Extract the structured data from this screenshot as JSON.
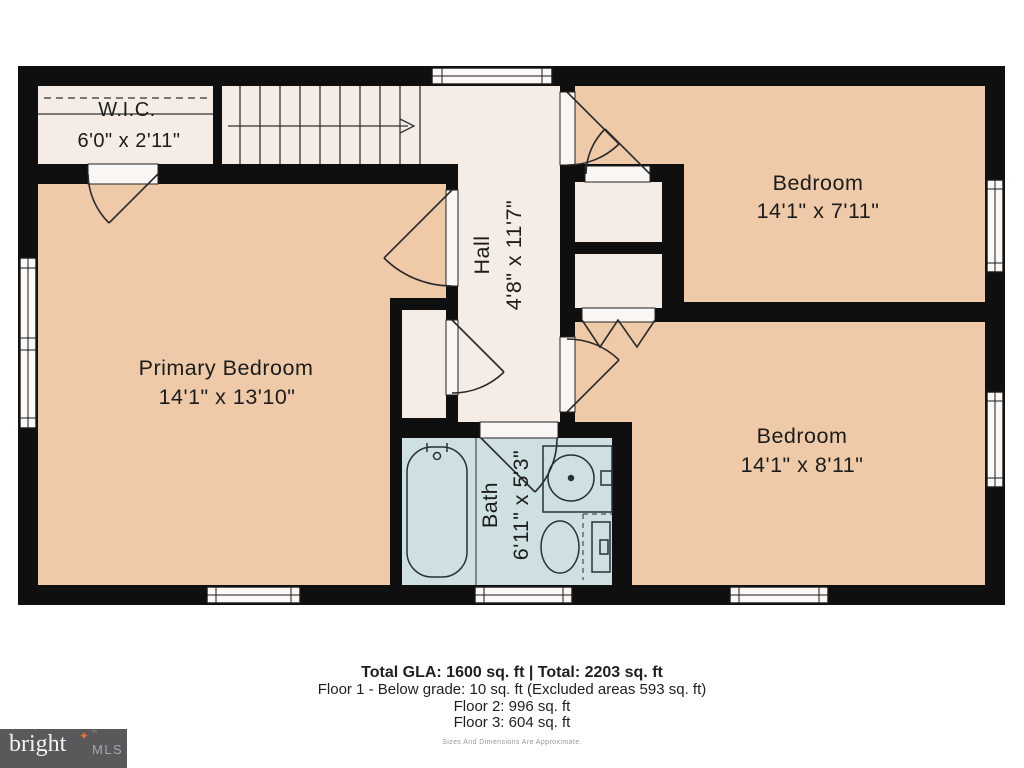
{
  "rooms": {
    "wic": {
      "label": "W.I.C.",
      "dims": "6'0\" x 2'11\""
    },
    "primary": {
      "label": "Primary Bedroom",
      "dims": "14'1\" x 13'10\""
    },
    "bedroom_top": {
      "label": "Bedroom",
      "dims": "14'1\" x 7'11\""
    },
    "bedroom_bottom": {
      "label": "Bedroom",
      "dims": "14'1\" x 8'11\""
    },
    "hall": {
      "label": "Hall",
      "dims": "4'8\" x 11'7\""
    },
    "bath": {
      "label": "Bath",
      "dims": "6'11\" x 5'3\""
    }
  },
  "summary": {
    "line1": "Total GLA: 1600 sq. ft | Total: 2203 sq. ft",
    "line2": "Floor 1 - Below grade: 10 sq. ft (Excluded areas 593 sq. ft)",
    "line3": "Floor 2: 996 sq. ft",
    "line4": "Floor 3: 604 sq. ft",
    "disclaimer": "Sizes And Dimensions Are Approximate."
  },
  "logo": {
    "brand": "bright",
    "suffix": "MLS",
    "star": "✦",
    "tm": "™"
  },
  "colors": {
    "bedroom": "#eecaa8",
    "corridor": "#f4ece5",
    "bath": "#cfe0e2",
    "wall": "#0f0f0f",
    "logo_bg": "#59595b",
    "logo_star": "#e0713a"
  }
}
